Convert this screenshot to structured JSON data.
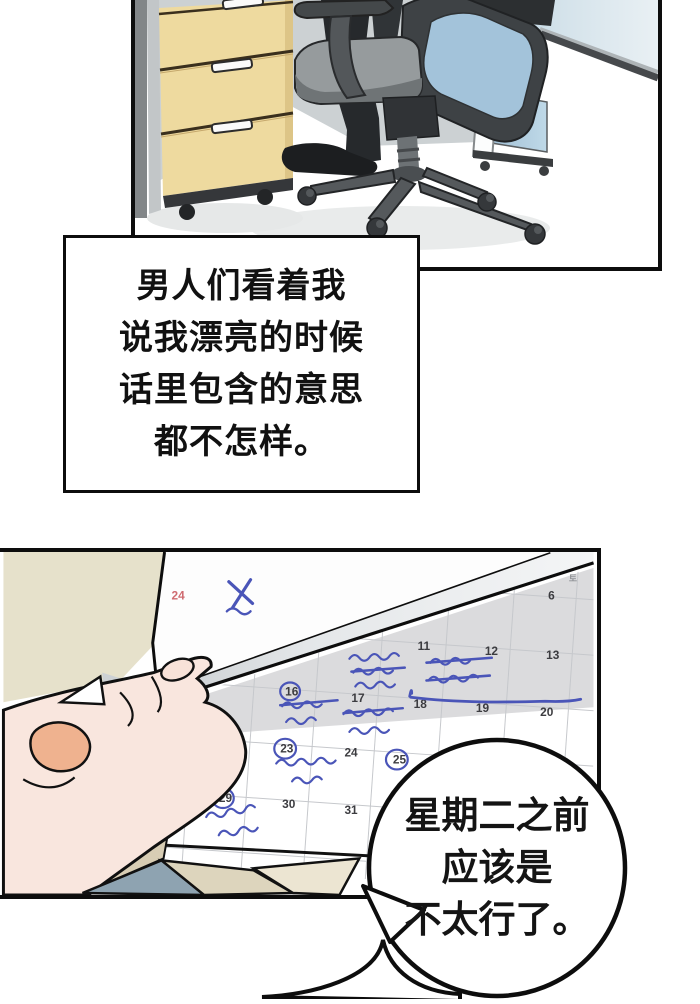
{
  "narration": {
    "lines": [
      "男人们看着我",
      "说我漂亮的时候",
      "话里包含的意思",
      "都不怎样。"
    ]
  },
  "bubble": {
    "lines": [
      "星期二之前",
      "应该是",
      "不太行了。"
    ]
  },
  "calendar": {
    "weekday_header": "토",
    "flipped_page_day": "24",
    "flipped_page_mark": "x-mark",
    "cells": [
      {
        "label": "6",
        "color": "dark",
        "circled": false
      },
      {
        "label": "11",
        "color": "dark",
        "circled": false
      },
      {
        "label": "12",
        "color": "dark",
        "circled": false
      },
      {
        "label": "13",
        "color": "dark",
        "circled": false
      },
      {
        "label": "16",
        "color": "dark",
        "circled": true
      },
      {
        "label": "17",
        "color": "dark",
        "circled": false
      },
      {
        "label": "18",
        "color": "dark",
        "circled": false
      },
      {
        "label": "19",
        "color": "dark",
        "circled": false
      },
      {
        "label": "20",
        "color": "dark",
        "circled": false
      },
      {
        "label": "21",
        "color": "red",
        "circled": false
      },
      {
        "label": "22",
        "color": "dark",
        "circled": false
      },
      {
        "label": "23",
        "color": "dark",
        "circled": true
      },
      {
        "label": "24",
        "color": "dark",
        "circled": false
      },
      {
        "label": "25",
        "color": "dark",
        "circled": true
      },
      {
        "label": "28",
        "color": "red",
        "circled": false
      },
      {
        "label": "29",
        "color": "dark",
        "circled": true
      },
      {
        "label": "30",
        "color": "dark",
        "circled": false
      },
      {
        "label": "31",
        "color": "dark",
        "circled": false
      }
    ],
    "handwritten_notes": [
      {
        "near_day": "11",
        "text": "에버샤 촬영 24 호디",
        "strikethrough": true
      },
      {
        "near_day": "12",
        "text": "9AM 정기회의",
        "strikethrough": true
      },
      {
        "near_day": "16",
        "text": "정리변서 추심",
        "strikethrough": true
      },
      {
        "near_day": "17",
        "text": "주간업무 보고서",
        "strikethrough": true
      },
      {
        "near_day": "23",
        "text": "제품기획형 미팅",
        "strikethrough": false
      },
      {
        "near_day": "29",
        "text": "최민경 사장님",
        "strikethrough": false
      }
    ]
  },
  "colors": {
    "ink_blue": "#4a55b8",
    "calendar_red": "#cf6b70",
    "wall_beige": "#e6e1cb",
    "cabinet_wood": "#eeda9f",
    "glass_blue": "#bfd9e8",
    "skin": "#f9e6de",
    "thumb_skin": "#efb28f",
    "page_shadow": "#dbdbdd",
    "panel_border": "#0d0d0d"
  }
}
